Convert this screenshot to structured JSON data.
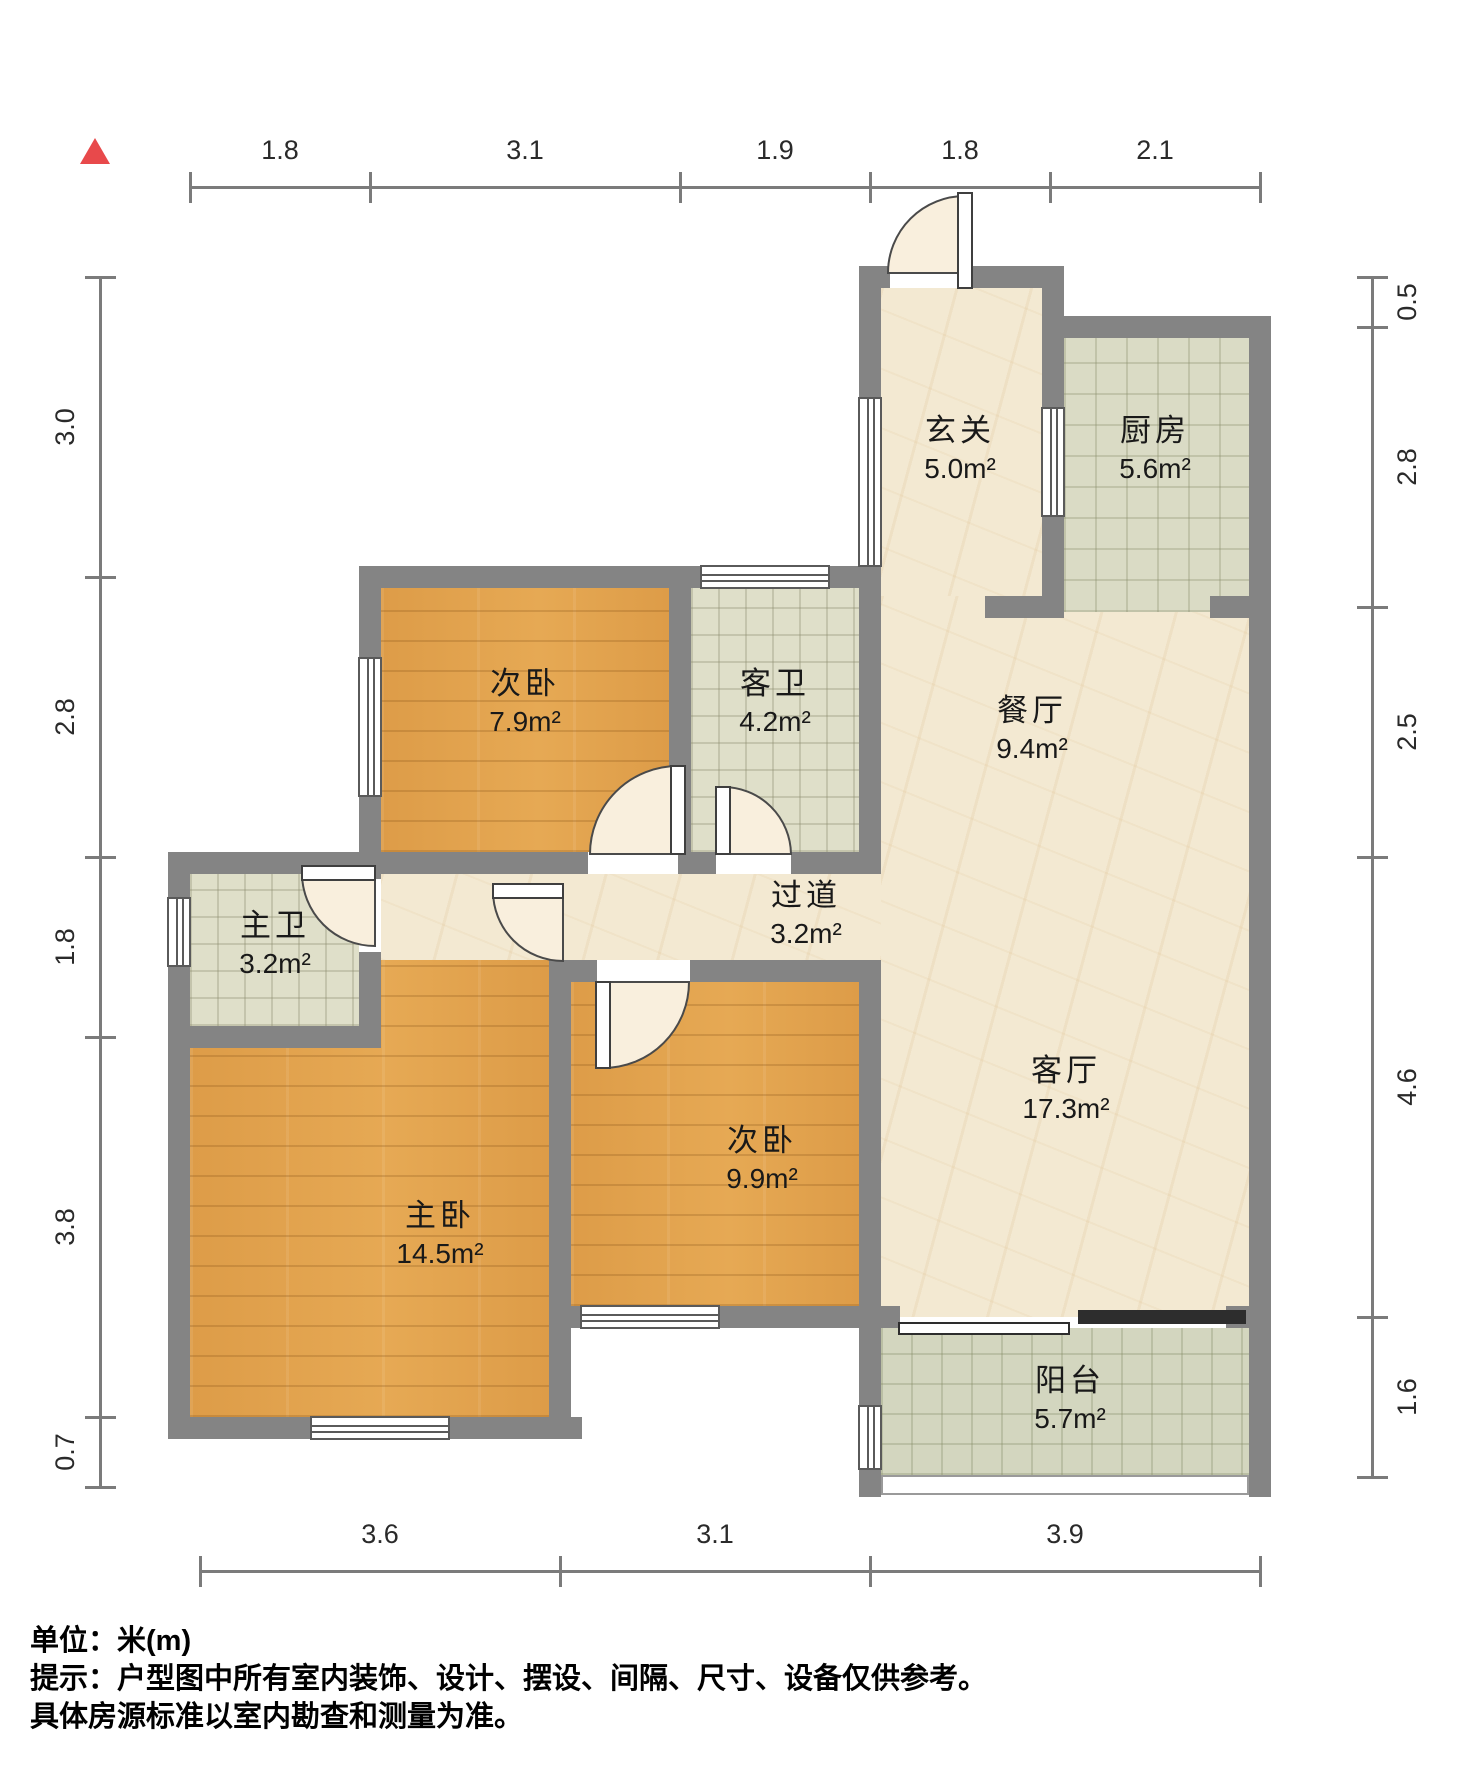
{
  "title": "户型图",
  "unit_note": "单位：米(m)",
  "footer": {
    "line1": "单位：米(m)",
    "line2": "提示：户型图中所有室内装饰、设计、摆设、间隔、尺寸、设备仅供参考。",
    "line3": "具体房源标准以室内勘查和测量为准。"
  },
  "north_color": "#e8494b",
  "colors": {
    "wall": "#848484",
    "wood": "#e0a04f",
    "marble": "#f3e9d2",
    "bath_tile": "#dfdfc9",
    "kitchen_tile": "#dadbc5",
    "balcony_tile": "#d3d6bf",
    "door_arc_fill": "#f9efdd",
    "dim": "#7b7b7b"
  },
  "plan": {
    "rooms": [
      {
        "id": "entry",
        "name": "玄关",
        "area": "5.0m²",
        "cx": 960,
        "cy": 450
      },
      {
        "id": "kitchen",
        "name": "厨房",
        "area": "5.6m²",
        "cx": 1155,
        "cy": 450
      },
      {
        "id": "dining",
        "name": "餐厅",
        "area": "9.4m²",
        "cx": 1032,
        "cy": 730
      },
      {
        "id": "guest-bath",
        "name": "客卫",
        "area": "4.2m²",
        "cx": 775,
        "cy": 703
      },
      {
        "id": "bedroom-2",
        "name": "次卧",
        "area": "7.9m²",
        "cx": 525,
        "cy": 703
      },
      {
        "id": "master-bath",
        "name": "主卫",
        "area": "3.2m²",
        "cx": 275,
        "cy": 945
      },
      {
        "id": "corridor",
        "name": "过道",
        "area": "3.2m²",
        "cx": 806,
        "cy": 915
      },
      {
        "id": "living",
        "name": "客厅",
        "area": "17.3m²",
        "cx": 1066,
        "cy": 1090
      },
      {
        "id": "bedroom-3",
        "name": "次卧",
        "area": "9.9m²",
        "cx": 762,
        "cy": 1160
      },
      {
        "id": "master-bedroom",
        "name": "主卧",
        "area": "14.5m²",
        "cx": 440,
        "cy": 1235
      },
      {
        "id": "balcony",
        "name": "阳台",
        "area": "5.7m²",
        "cx": 1070,
        "cy": 1400
      }
    ],
    "floors": [
      {
        "id": "entry",
        "type": "marble",
        "x": 881,
        "y": 288,
        "w": 161,
        "h": 319
      },
      {
        "id": "dining-living",
        "type": "marble",
        "x": 881,
        "y": 596,
        "w": 368,
        "h": 721
      },
      {
        "id": "corridor",
        "type": "marble",
        "x": 381,
        "y": 874,
        "w": 500,
        "h": 86
      },
      {
        "id": "kitchen",
        "type": "tilek",
        "x": 1064,
        "y": 338,
        "w": 185,
        "h": 274
      },
      {
        "id": "guest-bath",
        "type": "tileb",
        "x": 691,
        "y": 588,
        "w": 168,
        "h": 264
      },
      {
        "id": "master-bath",
        "type": "tileb",
        "x": 190,
        "y": 874,
        "w": 169,
        "h": 152
      },
      {
        "id": "bedroom-2",
        "type": "wood",
        "x": 381,
        "y": 588,
        "w": 288,
        "h": 264
      },
      {
        "id": "bedroom-3",
        "type": "wood",
        "x": 571,
        "y": 982,
        "w": 288,
        "h": 324
      },
      {
        "id": "master-bedroom",
        "type": "wood",
        "x": 190,
        "y": 960,
        "w": 359,
        "h": 457,
        "clip": "polygon(191px 0px, 359px 0px, 359px 457px, 0px 457px, 0px 88px, 191px 88px)"
      },
      {
        "id": "balcony",
        "type": "tilebal",
        "x": 881,
        "y": 1328,
        "w": 368,
        "h": 147
      }
    ],
    "walls": [
      [
        859,
        266,
        31,
        22
      ],
      [
        965,
        266,
        99,
        22
      ],
      [
        1042,
        266,
        22,
        141
      ],
      [
        1042,
        517,
        22,
        101
      ],
      [
        1042,
        316,
        229,
        22
      ],
      [
        1249,
        316,
        22,
        1181
      ],
      [
        985,
        596,
        65,
        22
      ],
      [
        1210,
        596,
        61,
        22
      ],
      [
        859,
        266,
        22,
        131
      ],
      [
        859,
        567,
        22,
        32
      ],
      [
        359,
        566,
        341,
        22
      ],
      [
        830,
        566,
        51,
        22
      ],
      [
        359,
        566,
        22,
        91
      ],
      [
        359,
        797,
        22,
        77
      ],
      [
        359,
        852,
        229,
        22
      ],
      [
        678,
        852,
        38,
        22
      ],
      [
        791,
        852,
        68,
        22
      ],
      [
        669,
        588,
        22,
        264
      ],
      [
        859,
        588,
        22,
        286
      ],
      [
        859,
        960,
        22,
        357
      ],
      [
        859,
        1317,
        22,
        88
      ],
      [
        859,
        1470,
        22,
        27
      ],
      [
        168,
        852,
        213,
        22
      ],
      [
        168,
        852,
        22,
        45
      ],
      [
        168,
        967,
        22,
        81
      ],
      [
        168,
        1026,
        213,
        22
      ],
      [
        359,
        852,
        22,
        27
      ],
      [
        359,
        952,
        22,
        96
      ],
      [
        168,
        1026,
        22,
        413
      ],
      [
        168,
        1417,
        142,
        22
      ],
      [
        450,
        1417,
        132,
        22
      ],
      [
        549,
        960,
        22,
        479
      ],
      [
        549,
        960,
        48,
        22
      ],
      [
        690,
        960,
        191,
        22
      ],
      [
        549,
        1306,
        31,
        22
      ],
      [
        720,
        1306,
        161,
        22
      ],
      [
        881,
        1306,
        19,
        22
      ],
      [
        1226,
        1306,
        45,
        22
      ]
    ],
    "windows": [
      {
        "id": "entry-left",
        "o": "v",
        "x": 858,
        "y": 397,
        "w": 24,
        "h": 170
      },
      {
        "id": "entry-kitchen",
        "o": "v",
        "x": 1041,
        "y": 407,
        "w": 24,
        "h": 110
      },
      {
        "id": "bedroom2-left",
        "o": "v",
        "x": 358,
        "y": 657,
        "w": 24,
        "h": 140
      },
      {
        "id": "guest-bath-top",
        "o": "h",
        "x": 700,
        "y": 565,
        "w": 130,
        "h": 24
      },
      {
        "id": "master-bath-left",
        "o": "v",
        "x": 167,
        "y": 897,
        "w": 24,
        "h": 70
      },
      {
        "id": "master-bottom",
        "o": "h",
        "x": 310,
        "y": 1416,
        "w": 140,
        "h": 24
      },
      {
        "id": "bedroom3-bottom",
        "o": "h",
        "x": 580,
        "y": 1305,
        "w": 140,
        "h": 24
      },
      {
        "id": "balcony-left",
        "o": "v",
        "x": 858,
        "y": 1405,
        "w": 24,
        "h": 65
      }
    ],
    "doors": [
      {
        "id": "entrance",
        "leaf": [
          958,
          193,
          14,
          95
        ],
        "arc": "M 965 196 A 77 77 0 0 0 888 273 L 965 273 Z"
      },
      {
        "id": "bedroom-2",
        "leaf": [
          671,
          766,
          14,
          88
        ],
        "arc": "M 678 766 A 88 88 0 0 0 590 854 L 678 854 Z"
      },
      {
        "id": "guest-bath",
        "leaf": [
          716,
          787,
          14,
          67
        ],
        "arc": "M 723 787 A 68 68 0 0 1 791 854 L 723 854 Z"
      },
      {
        "id": "master-bath",
        "leaf": [
          302,
          866,
          73,
          14
        ],
        "arc": "M 302 873 A 73 73 0 0 0 375 946 L 375 873 Z"
      },
      {
        "id": "master-bedroom",
        "leaf": [
          493,
          884,
          70,
          14
        ],
        "arc": "M 493 891 A 70 70 0 0 0 563 961 L 563 891 Z"
      },
      {
        "id": "bedroom-3",
        "leaf": [
          596,
          982,
          14,
          86
        ],
        "arc": "M 603 1068 A 86 86 0 0 0 689 982 L 603 982 Z"
      }
    ],
    "slider": [
      {
        "id": "balcony-slider-left",
        "kind": "light",
        "x": 898,
        "y": 1322,
        "w": 172,
        "h": 13
      },
      {
        "id": "balcony-slider-right",
        "kind": "dark",
        "x": 1078,
        "y": 1310,
        "w": 168,
        "h": 14
      }
    ],
    "rail": {
      "x": 881,
      "y": 1475,
      "w": 368,
      "h": 20
    },
    "dims": {
      "top": {
        "line": {
          "x": 190,
          "y": 186,
          "len": 1070
        },
        "ticks": [
          190,
          370,
          680,
          870,
          1050,
          1260
        ],
        "labels": [
          {
            "t": "1.8",
            "c": 280
          },
          {
            "t": "3.1",
            "c": 525
          },
          {
            "t": "1.9",
            "c": 775
          },
          {
            "t": "1.8",
            "c": 960
          },
          {
            "t": "2.1",
            "c": 1155
          }
        ]
      },
      "bottom": {
        "line": {
          "x": 200,
          "y": 1570,
          "len": 1060
        },
        "ticks": [
          200,
          560,
          870,
          1260
        ],
        "labels": [
          {
            "t": "3.6",
            "c": 380
          },
          {
            "t": "3.1",
            "c": 715
          },
          {
            "t": "3.9",
            "c": 1065
          }
        ]
      },
      "left": {
        "line": {
          "x": 99,
          "y": 277,
          "len": 1210
        },
        "ticks": [
          277,
          577,
          857,
          1037,
          1417,
          1487
        ],
        "labels": [
          {
            "t": "3.0",
            "c": 427
          },
          {
            "t": "2.8",
            "c": 717
          },
          {
            "t": "1.8",
            "c": 947
          },
          {
            "t": "3.8",
            "c": 1227
          },
          {
            "t": "0.7",
            "c": 1452
          }
        ]
      },
      "right": {
        "line": {
          "x": 1371,
          "y": 277,
          "len": 1200
        },
        "ticks": [
          277,
          327,
          607,
          857,
          1317,
          1477
        ],
        "labels": [
          {
            "t": "0.5",
            "c": 302
          },
          {
            "t": "2.8",
            "c": 467
          },
          {
            "t": "2.5",
            "c": 732
          },
          {
            "t": "4.6",
            "c": 1087
          },
          {
            "t": "1.6",
            "c": 1397
          }
        ]
      }
    }
  }
}
